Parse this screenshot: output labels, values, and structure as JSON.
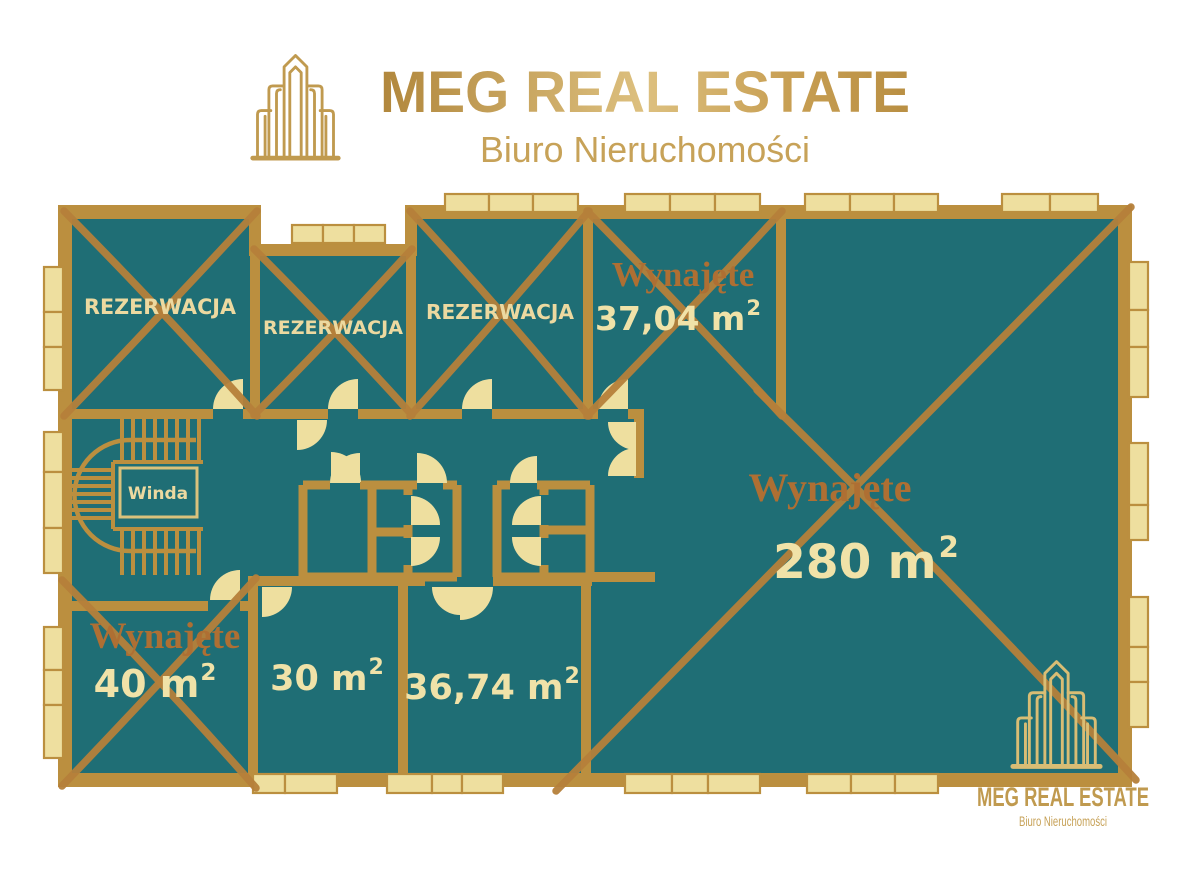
{
  "header": {
    "brand": "MEG REAL ESTATE",
    "tagline": "Biuro Nieruchomości"
  },
  "plan": {
    "elevator_label": "Winda",
    "rooms": {
      "rez1": {
        "label": "REZERWACJA"
      },
      "rez2": {
        "label": "REZERWACJA"
      },
      "rez3": {
        "label": "REZERWACJA"
      },
      "unit_3704": {
        "status": "Wynajęte",
        "area": "37,04 m",
        "area_sup": "2"
      },
      "unit_280": {
        "status": "Wynajęte",
        "area": "280 m",
        "area_sup": "2"
      },
      "unit_40": {
        "status": "Wynajęte",
        "area": "40 m",
        "area_sup": "2"
      },
      "unit_30": {
        "area": "30 m",
        "area_sup": "2"
      },
      "unit_3674": {
        "area": "36,74 m",
        "area_sup": "2"
      }
    },
    "colors": {
      "floor": "#1f6e75",
      "walls": "#bb8f3f",
      "windows": "#eedf9f",
      "stroke_x": "#b5803a",
      "rented_text": "#ae6f33",
      "area_text": "#f0e2a8",
      "label_text": "#ecd9a0",
      "logo_gold": "#c09a4f",
      "logo_cream": "#d9bd74",
      "tagline_gold": "#c7a258"
    }
  },
  "footer": {
    "brand": "MEG REAL ESTATE",
    "tagline": "Biuro Nieruchomości"
  }
}
